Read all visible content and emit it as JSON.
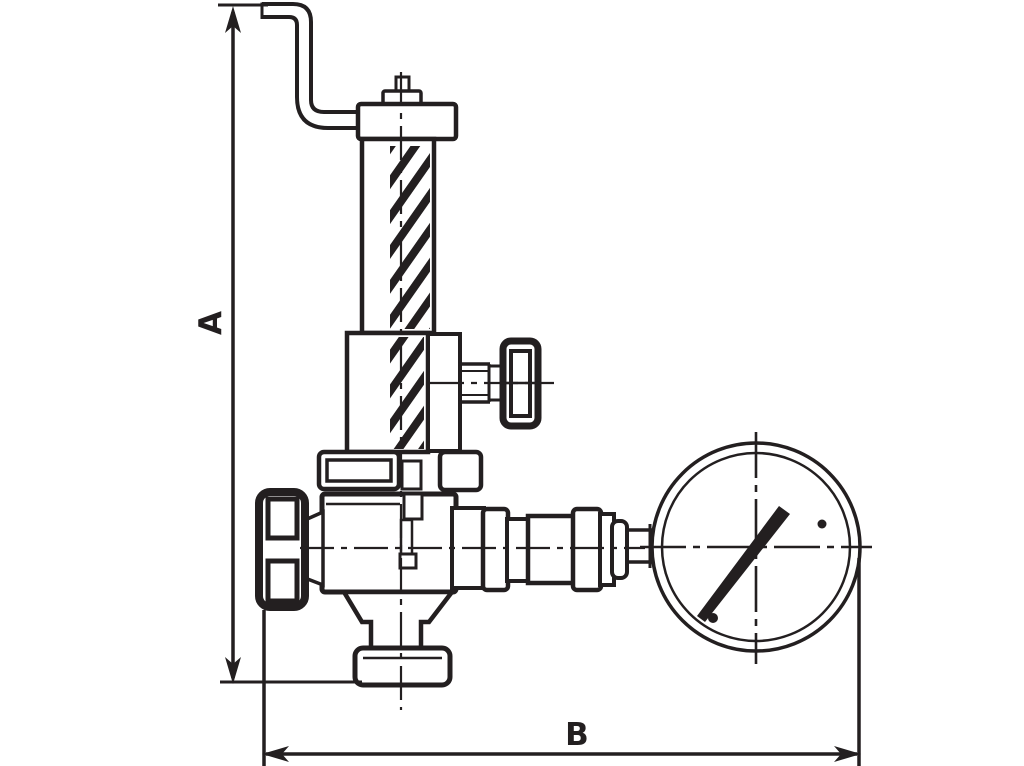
{
  "drawing": {
    "type": "technical-line-drawing",
    "subject": "angle safety valve with drain pipe, isolating handwheels and pressure gauge",
    "dimension_a_label": "A",
    "dimension_b_label": "B"
  },
  "colors": {
    "ink": "#231f20",
    "background": "#ffffff"
  },
  "parts": [
    "drain-pipe",
    "adjusting-cap",
    "spring-bonnet",
    "spring",
    "gauge-isolator-handwheel",
    "union-flange",
    "valve-body",
    "inlet-handwheel",
    "gauge-connection-fittings",
    "pressure-gauge",
    "bottom-flange"
  ]
}
